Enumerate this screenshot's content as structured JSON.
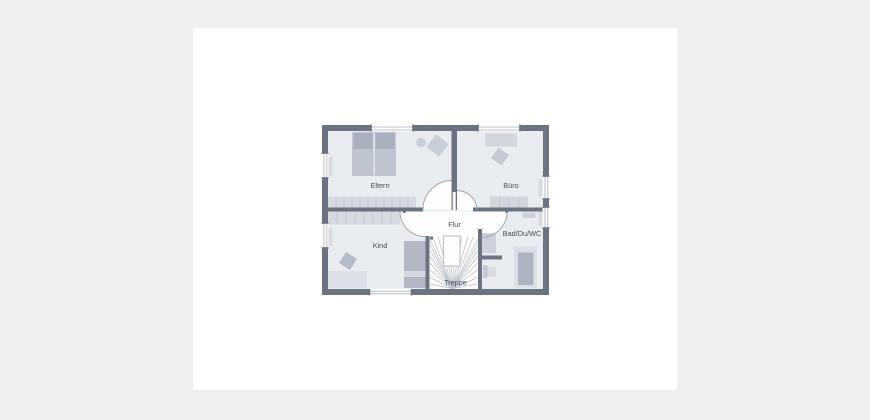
{
  "page": {
    "background_color": "#efefef",
    "card_color": "#ffffff",
    "content_type": "floor-plan-upper-storey"
  },
  "floorplan": {
    "labels": {
      "eltern": "Eltern",
      "buero": "Büro",
      "flur": "Flur",
      "kind": "Kind",
      "bad": "Bad/Du/WC",
      "treppe": "Treppe"
    },
    "colors": {
      "wall": "#6b7380",
      "room_floor": "#e9edf2",
      "hall_floor": "#fdfdfe",
      "furniture_light": "#d6dae1",
      "furniture_medium": "#c3c9d4",
      "furniture_dark": "#a9b0bd",
      "arc_stroke": "#9aa1ac",
      "tread_stroke": "#b9bfc9",
      "label_color": "#454c5b"
    },
    "rooms": [
      "Eltern",
      "Büro",
      "Flur",
      "Kind",
      "Bad/Du/WC",
      "Treppe"
    ]
  }
}
